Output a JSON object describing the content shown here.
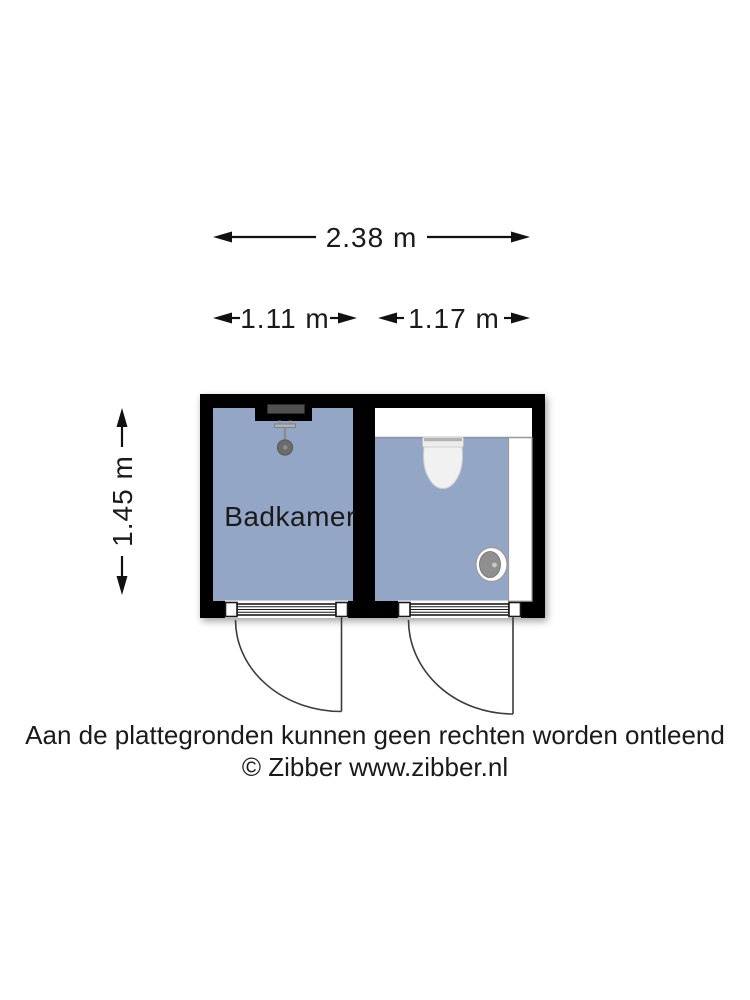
{
  "colors": {
    "floor": "#93a6c6",
    "wall": "#000000",
    "fixture_white": "#ffffff",
    "shower_head_gray": "#6c6c6c",
    "sink_basin_gray": "#8f8f8f",
    "text": "#1a1a1a"
  },
  "dimensions": {
    "total_width": {
      "label": "2.38 m"
    },
    "badkamer_width": {
      "label": "1.11 m"
    },
    "toilet_width": {
      "label": "1.17 m"
    },
    "plan_depth": {
      "label": "1.45 m"
    }
  },
  "rooms": {
    "badkamer": {
      "label": "Badkamer"
    }
  },
  "fixtures": [
    "shower",
    "toilet",
    "hand-basin",
    "cistern",
    "cabinet"
  ],
  "footer": {
    "disclaimer": "Aan de plattegronden kunnen geen rechten worden ontleend",
    "copyright": "© Zibber www.zibber.nl"
  }
}
